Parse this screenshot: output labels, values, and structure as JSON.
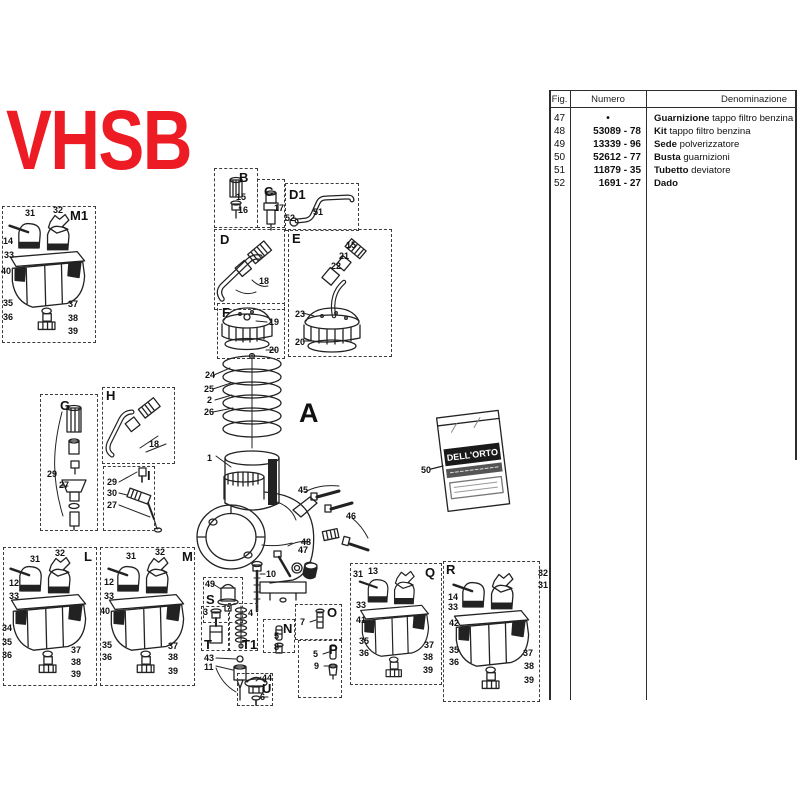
{
  "logo": {
    "text": "VHSB",
    "color": "#ed1c24"
  },
  "table": {
    "headers": [
      "Fig.",
      "Numero",
      "Denominazione"
    ],
    "rows": [
      {
        "fig": "47",
        "numero": "•",
        "bold": "Guarnizione",
        "rest": "tappo filtro benzina"
      },
      {
        "fig": "48",
        "numero": "53089 - 78",
        "bold": "Kit",
        "rest": "tappo filtro benzina"
      },
      {
        "fig": "49",
        "numero": "13339 - 96",
        "bold": "Sede",
        "rest": "polverizzatore"
      },
      {
        "fig": "50",
        "numero": "52612 - 77",
        "bold": "Busta",
        "rest": "guarnizioni"
      },
      {
        "fig": "51",
        "numero": "11879 - 35",
        "bold": "Tubetto",
        "rest": "deviatore"
      },
      {
        "fig": "52",
        "numero": "1691 - 27",
        "bold": "Dado",
        "rest": ""
      }
    ]
  },
  "diagram": {
    "main_label": "A",
    "packet": {
      "brand": "DELL'ORTO"
    },
    "sections": [
      {
        "label": "M1",
        "box": [
          2,
          206,
          94,
          137
        ],
        "label_pos": [
          70,
          209
        ]
      },
      {
        "label": "B",
        "box": [
          214,
          168,
          44,
          60
        ],
        "label_pos": [
          239,
          171
        ]
      },
      {
        "label": "C",
        "box": [
          257,
          179,
          28,
          49
        ],
        "label_pos": [
          264,
          185
        ]
      },
      {
        "label": "D1",
        "box": [
          285,
          183,
          74,
          48
        ],
        "label_pos": [
          289,
          188
        ]
      },
      {
        "label": "D",
        "box": [
          214,
          229,
          71,
          81
        ],
        "label_pos": [
          220,
          233
        ]
      },
      {
        "label": "E",
        "box": [
          288,
          229,
          104,
          128
        ],
        "label_pos": [
          292,
          232
        ]
      },
      {
        "label": "F",
        "box": [
          217,
          303,
          68,
          56
        ],
        "label_pos": [
          222,
          306
        ]
      },
      {
        "label": "G",
        "box": [
          40,
          394,
          58,
          137
        ],
        "label_pos": [
          60,
          399
        ]
      },
      {
        "label": "H",
        "box": [
          102,
          387,
          73,
          77
        ],
        "label_pos": [
          106,
          389
        ]
      },
      {
        "label": "I",
        "box": [
          103,
          466,
          52,
          65
        ],
        "label_pos": [
          147,
          469
        ]
      },
      {
        "label": "L",
        "box": [
          3,
          547,
          94,
          139
        ],
        "label_pos": [
          84,
          550
        ]
      },
      {
        "label": "M",
        "box": [
          100,
          547,
          95,
          139
        ],
        "label_pos": [
          182,
          550
        ]
      },
      {
        "label": "S",
        "box": [
          203,
          577,
          40,
          46
        ],
        "label_pos": [
          206,
          593
        ]
      },
      {
        "label": "T",
        "box": [
          201,
          606,
          29,
          45
        ],
        "label_pos": [
          204,
          638
        ]
      },
      {
        "label": "T1",
        "box": [
          228,
          603,
          30,
          48
        ],
        "label_pos": [
          242,
          638
        ]
      },
      {
        "label": "N",
        "box": [
          263,
          619,
          32,
          34
        ],
        "label_pos": [
          283,
          622
        ]
      },
      {
        "label": "O",
        "box": [
          295,
          604,
          47,
          36
        ],
        "label_pos": [
          327,
          606
        ]
      },
      {
        "label": "P",
        "box": [
          298,
          640,
          44,
          58
        ],
        "label_pos": [
          329,
          643
        ]
      },
      {
        "label": "U",
        "box": [
          237,
          673,
          36,
          33
        ],
        "label_pos": [
          262,
          682
        ]
      },
      {
        "label": "Q",
        "box": [
          350,
          563,
          92,
          122
        ],
        "label_pos": [
          425,
          566
        ]
      },
      {
        "label": "R",
        "box": [
          443,
          561,
          97,
          141
        ],
        "label_pos": [
          446,
          563
        ]
      },
      {
        "label": "A",
        "box": null,
        "label_pos": [
          299,
          400
        ],
        "big": true
      }
    ],
    "callouts": [
      {
        "n": "31",
        "x": 25,
        "y": 209
      },
      {
        "n": "32",
        "x": 53,
        "y": 206
      },
      {
        "n": "14",
        "x": 3,
        "y": 237
      },
      {
        "n": "33",
        "x": 4,
        "y": 251
      },
      {
        "n": "40",
        "x": 1,
        "y": 267
      },
      {
        "n": "35",
        "x": 3,
        "y": 299
      },
      {
        "n": "36",
        "x": 3,
        "y": 313
      },
      {
        "n": "37",
        "x": 68,
        "y": 300
      },
      {
        "n": "38",
        "x": 68,
        "y": 314
      },
      {
        "n": "39",
        "x": 68,
        "y": 327
      },
      {
        "n": "15",
        "x": 236,
        "y": 193
      },
      {
        "n": "16",
        "x": 238,
        "y": 206
      },
      {
        "n": "17",
        "x": 274,
        "y": 204
      },
      {
        "n": "51",
        "x": 313,
        "y": 208
      },
      {
        "n": "52",
        "x": 285,
        "y": 214
      },
      {
        "n": "18",
        "x": 259,
        "y": 277
      },
      {
        "n": "15",
        "x": 346,
        "y": 241
      },
      {
        "n": "21",
        "x": 339,
        "y": 252
      },
      {
        "n": "22",
        "x": 331,
        "y": 262
      },
      {
        "n": "23",
        "x": 295,
        "y": 310
      },
      {
        "n": "20",
        "x": 295,
        "y": 338
      },
      {
        "n": "19",
        "x": 269,
        "y": 318
      },
      {
        "n": "20",
        "x": 269,
        "y": 346
      },
      {
        "n": "24",
        "x": 205,
        "y": 371
      },
      {
        "n": "25",
        "x": 204,
        "y": 385
      },
      {
        "n": "2",
        "x": 207,
        "y": 396
      },
      {
        "n": "26",
        "x": 204,
        "y": 408
      },
      {
        "n": "1",
        "x": 207,
        "y": 454
      },
      {
        "n": "45",
        "x": 298,
        "y": 486
      },
      {
        "n": "46",
        "x": 346,
        "y": 512
      },
      {
        "n": "48",
        "x": 301,
        "y": 538
      },
      {
        "n": "47",
        "x": 298,
        "y": 546
      },
      {
        "n": "10",
        "x": 266,
        "y": 570
      },
      {
        "n": "49",
        "x": 205,
        "y": 580
      },
      {
        "n": "29",
        "x": 47,
        "y": 470
      },
      {
        "n": "27",
        "x": 59,
        "y": 481
      },
      {
        "n": "18",
        "x": 149,
        "y": 440
      },
      {
        "n": "29",
        "x": 107,
        "y": 478
      },
      {
        "n": "30",
        "x": 107,
        "y": 489
      },
      {
        "n": "27",
        "x": 107,
        "y": 501
      },
      {
        "n": "31",
        "x": 30,
        "y": 555
      },
      {
        "n": "32",
        "x": 55,
        "y": 549
      },
      {
        "n": "12",
        "x": 9,
        "y": 579
      },
      {
        "n": "33",
        "x": 9,
        "y": 592
      },
      {
        "n": "34",
        "x": 2,
        "y": 624
      },
      {
        "n": "35",
        "x": 2,
        "y": 638
      },
      {
        "n": "36",
        "x": 2,
        "y": 651
      },
      {
        "n": "37",
        "x": 71,
        "y": 646
      },
      {
        "n": "38",
        "x": 71,
        "y": 658
      },
      {
        "n": "39",
        "x": 71,
        "y": 670
      },
      {
        "n": "31",
        "x": 126,
        "y": 552
      },
      {
        "n": "32",
        "x": 155,
        "y": 548
      },
      {
        "n": "12",
        "x": 104,
        "y": 578
      },
      {
        "n": "33",
        "x": 104,
        "y": 592
      },
      {
        "n": "40",
        "x": 100,
        "y": 607
      },
      {
        "n": "35",
        "x": 102,
        "y": 641
      },
      {
        "n": "36",
        "x": 102,
        "y": 653
      },
      {
        "n": "37",
        "x": 168,
        "y": 642
      },
      {
        "n": "38",
        "x": 168,
        "y": 653
      },
      {
        "n": "39",
        "x": 168,
        "y": 667
      },
      {
        "n": "3",
        "x": 203,
        "y": 608
      },
      {
        "n": "4",
        "x": 248,
        "y": 609
      },
      {
        "n": "43",
        "x": 204,
        "y": 654
      },
      {
        "n": "11",
        "x": 204,
        "y": 663
      },
      {
        "n": "44",
        "x": 262,
        "y": 674
      },
      {
        "n": "6",
        "x": 260,
        "y": 693
      },
      {
        "n": "5",
        "x": 274,
        "y": 632
      },
      {
        "n": "8",
        "x": 274,
        "y": 643
      },
      {
        "n": "7",
        "x": 300,
        "y": 618
      },
      {
        "n": "5",
        "x": 313,
        "y": 650
      },
      {
        "n": "9",
        "x": 314,
        "y": 662
      },
      {
        "n": "31",
        "x": 353,
        "y": 570
      },
      {
        "n": "13",
        "x": 368,
        "y": 567
      },
      {
        "n": "33",
        "x": 356,
        "y": 601
      },
      {
        "n": "41",
        "x": 356,
        "y": 616
      },
      {
        "n": "35",
        "x": 359,
        "y": 637
      },
      {
        "n": "36",
        "x": 359,
        "y": 649
      },
      {
        "n": "37",
        "x": 424,
        "y": 641
      },
      {
        "n": "38",
        "x": 423,
        "y": 653
      },
      {
        "n": "39",
        "x": 423,
        "y": 666
      },
      {
        "n": "32",
        "x": 538,
        "y": 569
      },
      {
        "n": "31",
        "x": 538,
        "y": 581
      },
      {
        "n": "14",
        "x": 448,
        "y": 593
      },
      {
        "n": "33",
        "x": 448,
        "y": 603
      },
      {
        "n": "42",
        "x": 449,
        "y": 619
      },
      {
        "n": "35",
        "x": 449,
        "y": 646
      },
      {
        "n": "36",
        "x": 449,
        "y": 658
      },
      {
        "n": "37",
        "x": 523,
        "y": 649
      },
      {
        "n": "38",
        "x": 524,
        "y": 662
      },
      {
        "n": "39",
        "x": 524,
        "y": 676
      },
      {
        "n": "50",
        "x": 421,
        "y": 466
      }
    ]
  }
}
